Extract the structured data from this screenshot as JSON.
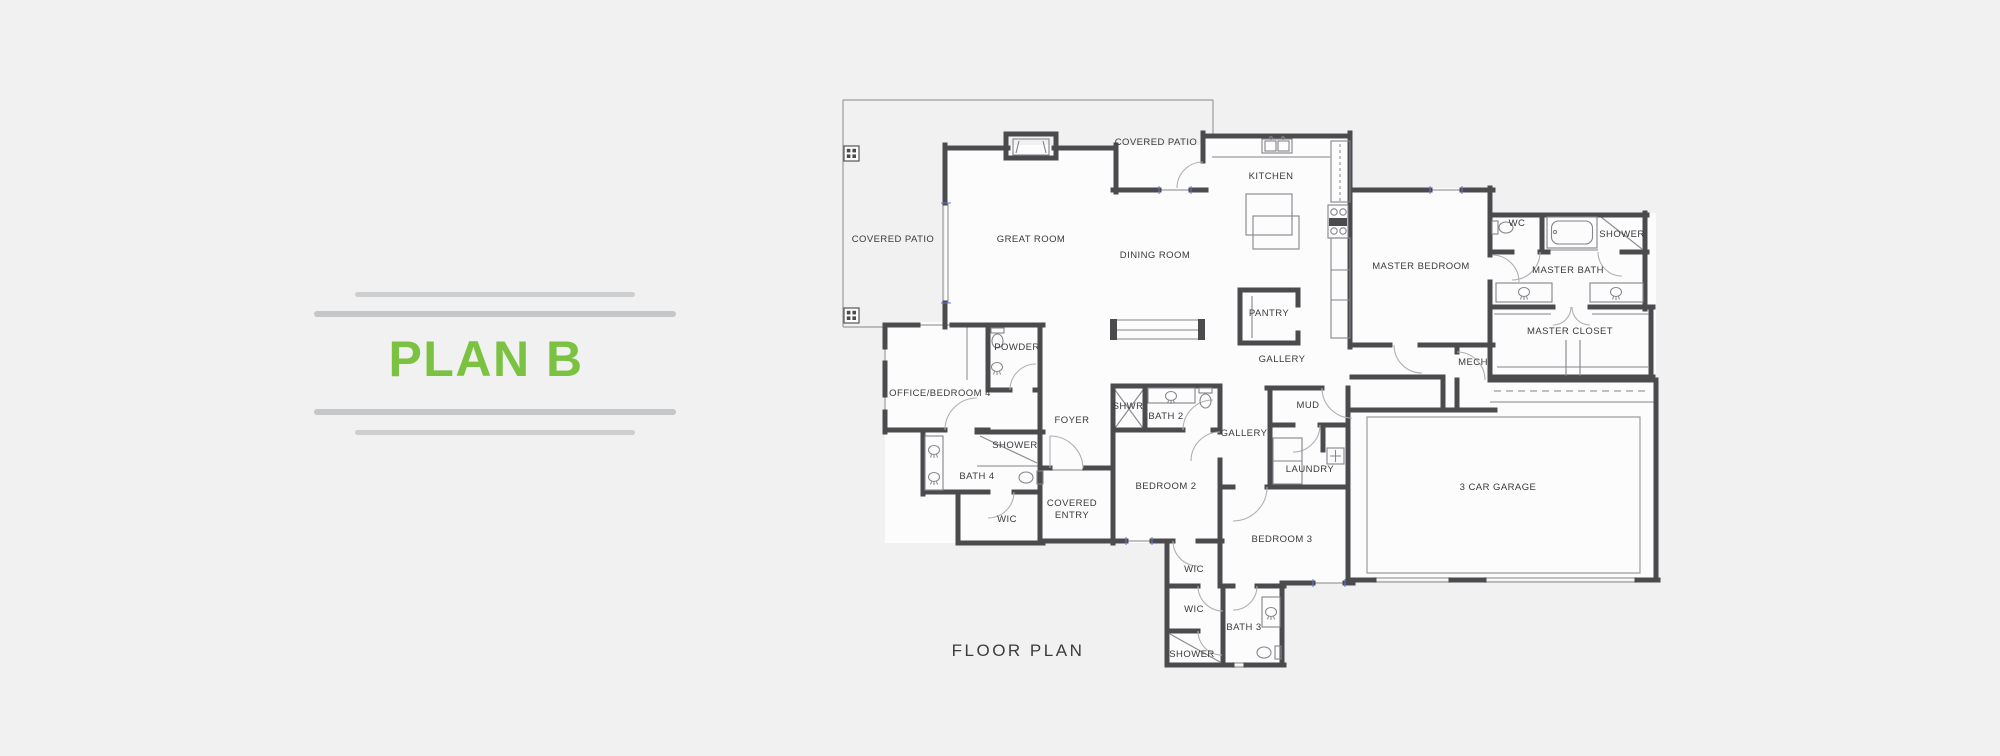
{
  "page": {
    "background": "#f1f1f2"
  },
  "title_panel": {
    "title": "PLAN B",
    "accent_color": "#7cc242",
    "line_color": "#c5c6c8"
  },
  "floor_plan": {
    "caption": "FLOOR PLAN",
    "wall_color": "#4b4b4e",
    "thin_line_color": "#9b9b9d",
    "label_color": "#3a3a3c",
    "window_tick_color": "#6673d6",
    "rooms": [
      {
        "id": "covered-patio-west",
        "label": "COVERED PATIO",
        "x": 893,
        "y": 240
      },
      {
        "id": "covered-patio-north",
        "label": "COVERED PATIO",
        "x": 1156,
        "y": 143
      },
      {
        "id": "great-room",
        "label": "GREAT ROOM",
        "x": 1031,
        "y": 240
      },
      {
        "id": "dining-room",
        "label": "DINING ROOM",
        "x": 1155,
        "y": 256
      },
      {
        "id": "kitchen",
        "label": "KITCHEN",
        "x": 1271,
        "y": 177
      },
      {
        "id": "pantry",
        "label": "PANTRY",
        "x": 1269,
        "y": 314
      },
      {
        "id": "gallery-1",
        "label": "GALLERY",
        "x": 1282,
        "y": 360
      },
      {
        "id": "master-bedroom",
        "label": "MASTER BEDROOM",
        "x": 1421,
        "y": 267
      },
      {
        "id": "wc",
        "label": "WC",
        "x": 1517,
        "y": 224
      },
      {
        "id": "master-shower",
        "label": "SHOWER",
        "x": 1622,
        "y": 235
      },
      {
        "id": "master-bath",
        "label": "MASTER BATH",
        "x": 1568,
        "y": 271
      },
      {
        "id": "master-closet",
        "label": "MASTER CLOSET",
        "x": 1570,
        "y": 332
      },
      {
        "id": "mech",
        "label": "MECH",
        "x": 1473,
        "y": 363
      },
      {
        "id": "mud",
        "label": "MUD",
        "x": 1308,
        "y": 406
      },
      {
        "id": "laundry",
        "label": "LAUNDRY",
        "x": 1310,
        "y": 470
      },
      {
        "id": "gallery-2",
        "label": "GALLERY",
        "x": 1244,
        "y": 434
      },
      {
        "id": "garage",
        "label": "3 CAR GARAGE",
        "x": 1498,
        "y": 488
      },
      {
        "id": "shwr-2",
        "label": "SHWR",
        "x": 1128,
        "y": 407
      },
      {
        "id": "bath-2",
        "label": "BATH 2",
        "x": 1166,
        "y": 417
      },
      {
        "id": "bedroom-2",
        "label": "BEDROOM 2",
        "x": 1166,
        "y": 487
      },
      {
        "id": "bedroom-3",
        "label": "BEDROOM 3",
        "x": 1282,
        "y": 540
      },
      {
        "id": "wic-bedroom-2",
        "label": "WIC",
        "x": 1194,
        "y": 570
      },
      {
        "id": "wic-bedroom-3",
        "label": "WIC",
        "x": 1194,
        "y": 610
      },
      {
        "id": "bath-3",
        "label": "BATH 3",
        "x": 1244,
        "y": 628
      },
      {
        "id": "shower-bath-3",
        "label": "SHOWER",
        "x": 1192,
        "y": 655
      },
      {
        "id": "office-bedroom-4",
        "label": "OFFICE/BEDROOM 4",
        "x": 940,
        "y": 394
      },
      {
        "id": "powder",
        "label": "POWDER",
        "x": 1017,
        "y": 348
      },
      {
        "id": "foyer",
        "label": "FOYER",
        "x": 1072,
        "y": 421
      },
      {
        "id": "shower-bath-4",
        "label": "SHOWER",
        "x": 1015,
        "y": 446
      },
      {
        "id": "bath-4",
        "label": "BATH 4",
        "x": 977,
        "y": 477
      },
      {
        "id": "wic-bedroom-4",
        "label": "WIC",
        "x": 1007,
        "y": 520
      },
      {
        "id": "covered-entry",
        "label": "COVERED\nENTRY",
        "x": 1072,
        "y": 510
      }
    ]
  }
}
